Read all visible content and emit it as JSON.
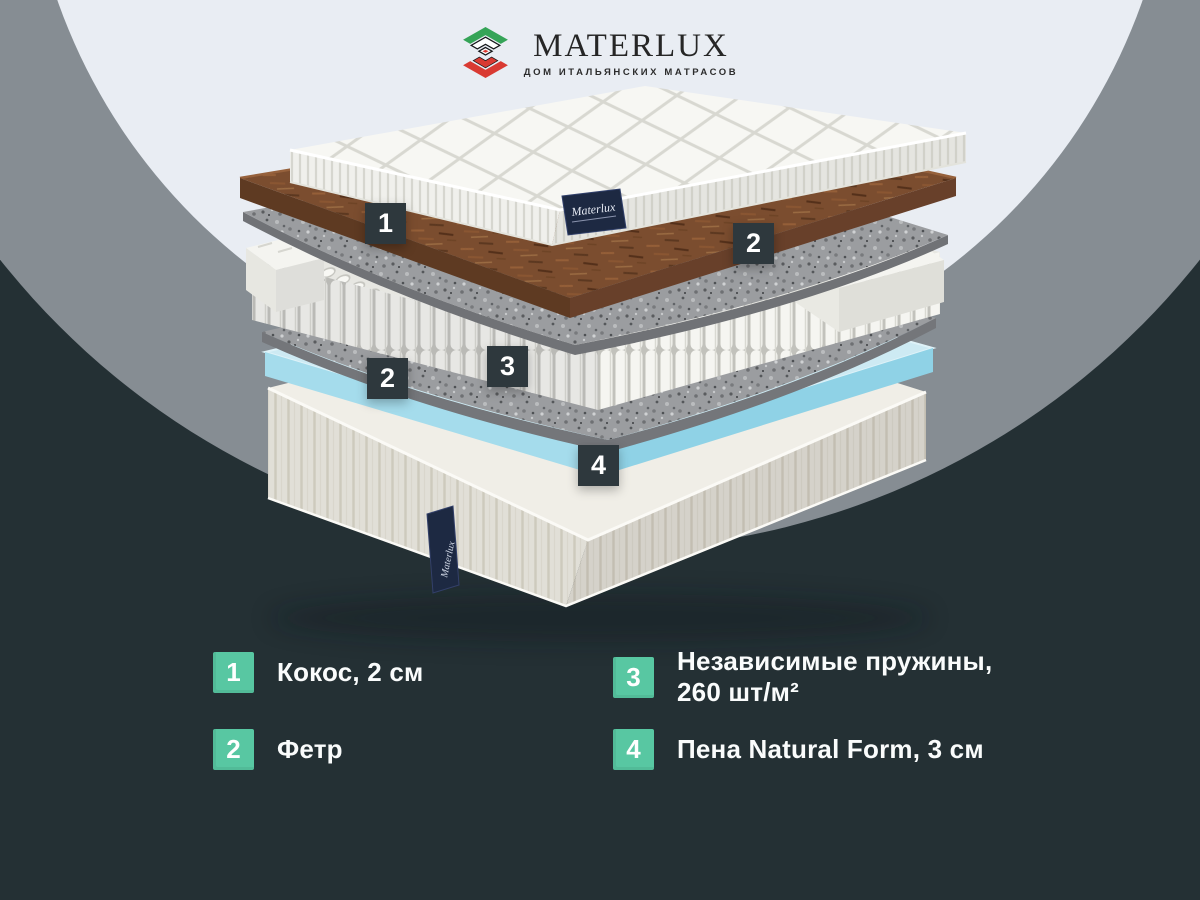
{
  "logo": {
    "brand": "MATERLUX",
    "tagline": "ДОМ ИТАЛЬЯНСКИХ МАТРАСОВ",
    "icon": "materlux-diamond-logo",
    "colors": {
      "green": "#35a457",
      "red": "#d93a32",
      "text": "#262626"
    }
  },
  "diagram": {
    "description": "exploded-mattress-layers",
    "quilt_tag_text": "Materlux",
    "base_tag_text": "Materlux",
    "markers": [
      {
        "label": "1"
      },
      {
        "label": "2"
      },
      {
        "label": "2"
      },
      {
        "label": "3"
      },
      {
        "label": "4"
      }
    ]
  },
  "legend": {
    "items": [
      {
        "num": "1",
        "lines": [
          "Кокос, 2 см",
          ""
        ]
      },
      {
        "num": "2",
        "lines": [
          "Фетр",
          ""
        ]
      },
      {
        "num": "3",
        "lines": [
          "Независимые пружины,",
          "260 шт/м²"
        ]
      },
      {
        "num": "4",
        "lines": [
          "Пена Natural Form, 3 см",
          ""
        ]
      }
    ],
    "badge_color": "#58c7a2",
    "text_color": "#fafcfc"
  },
  "colors": {
    "background": "#243034",
    "outer_circle": "#868d93",
    "inner_circle": "#e9edf3",
    "marker_badge": "#2e383d",
    "coir_brown": "#7b4d2f",
    "felt_gray": "#9b9da0",
    "foam_blue": "#a9dcec",
    "label_navy": "#1d2942"
  }
}
